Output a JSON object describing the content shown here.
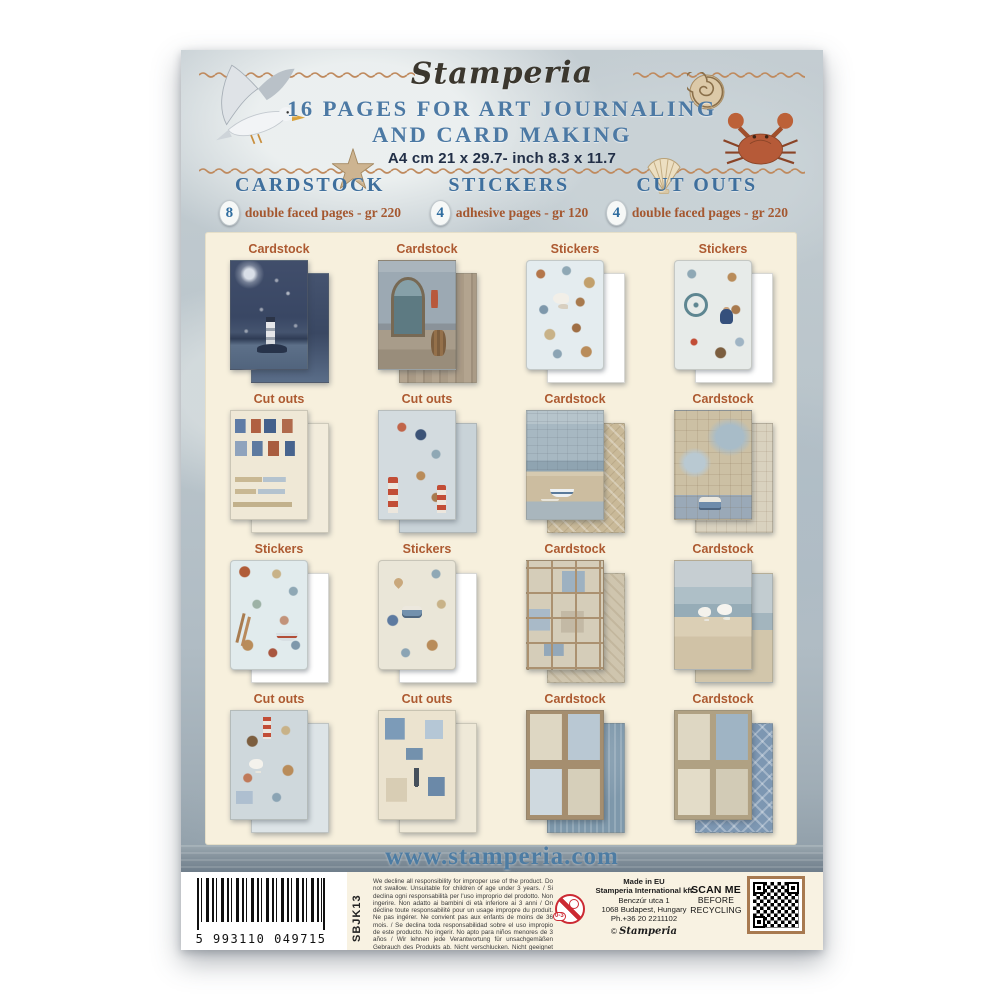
{
  "brand": {
    "logo_text": "Stamperia",
    "copyright_symbol": "©",
    "copyright_script": "Stamperia"
  },
  "header": {
    "title_line1": "16 PAGES FOR ART JOURNALING",
    "title_line2": "AND CARD MAKING",
    "size_line": "A4 cm 21 x 29.7- inch 8.3 x 11.7"
  },
  "contents": {
    "columns": [
      {
        "name": "CARDSTOCK",
        "count": "8",
        "desc": "double faced pages - gr 220"
      },
      {
        "name": "STICKERS",
        "count": "4",
        "desc": "adhesive pages - gr 120"
      },
      {
        "name": "CUT OUTS",
        "count": "4",
        "desc": "double faced pages - gr 220"
      }
    ]
  },
  "grid": {
    "items": [
      {
        "label": "Cardstock",
        "motif": "lighthouse-night"
      },
      {
        "label": "Cardstock",
        "motif": "sea-doorway"
      },
      {
        "label": "Stickers",
        "motif": "sea-creatures"
      },
      {
        "label": "Stickers",
        "motif": "ship-wheel"
      },
      {
        "label": "Cut outs",
        "motif": "houses"
      },
      {
        "label": "Cut outs",
        "motif": "lighthouse-figures"
      },
      {
        "label": "Cardstock",
        "motif": "harbor-beach"
      },
      {
        "label": "Cardstock",
        "motif": "map-van"
      },
      {
        "label": "Stickers",
        "motif": "shells-boat"
      },
      {
        "label": "Stickers",
        "motif": "van-hearts"
      },
      {
        "label": "Cardstock",
        "motif": "collage-frames"
      },
      {
        "label": "Cardstock",
        "motif": "horses-beach"
      },
      {
        "label": "Cut outs",
        "motif": "horses-lighthouse"
      },
      {
        "label": "Cut outs",
        "motif": "houses-anchor"
      },
      {
        "label": "Cardstock",
        "motif": "journaling-cards"
      },
      {
        "label": "Cardstock",
        "motif": "cards-diamond"
      }
    ]
  },
  "footer": {
    "website": "www.stamperia.com"
  },
  "label_strip": {
    "ean": "5 993110 049715",
    "sku": "SBJK13",
    "disclaimer": "We decline all responsibility for improper use of the product. Do not swallow. Unsuitable for children of age under 3 years. / Si declina ogni responsabilità per l'uso improprio del prodotto. Non ingerire. Non adatto ai bambini di età inferiore ai 3 anni / On décline toute responsabilité pour un usage impropre du produit. Ne pas ingérer. Ne convient pas aux enfants de moins de 36 mois. / Se declina toda responsabilidad sobre el uso impropio de este producto. No ingerir. No apto para niños menores de 3 años / Wir lehnen jede Verantwortung für unsachgemäßen Gebrauch des Produkts ab. Nicht verschlucken. Nicht geeignet für Kinder unter 3 Jahren.",
    "made_in": [
      "Made in EU",
      "Stamperia International kft",
      "Benczúr utca 1",
      "1068 Budapest, Hungary",
      "Ph.+36 20 2211102"
    ],
    "scan_lines": [
      "SCAN ME",
      "BEFORE",
      "RECYCLING"
    ],
    "age_warning": "0-3"
  },
  "colors": {
    "title_blue": "#4c79a4",
    "heading_blue": "#3e6f9d",
    "desc_rust": "#a4572f",
    "label_rust": "#ad5a31",
    "panel_cream": "#f7f0dd",
    "wave_tan": "#bf8a5e",
    "website_blue": "#4d7ca3",
    "qr_border": "#a87a50",
    "age_warning_red": "#cc2a33"
  }
}
